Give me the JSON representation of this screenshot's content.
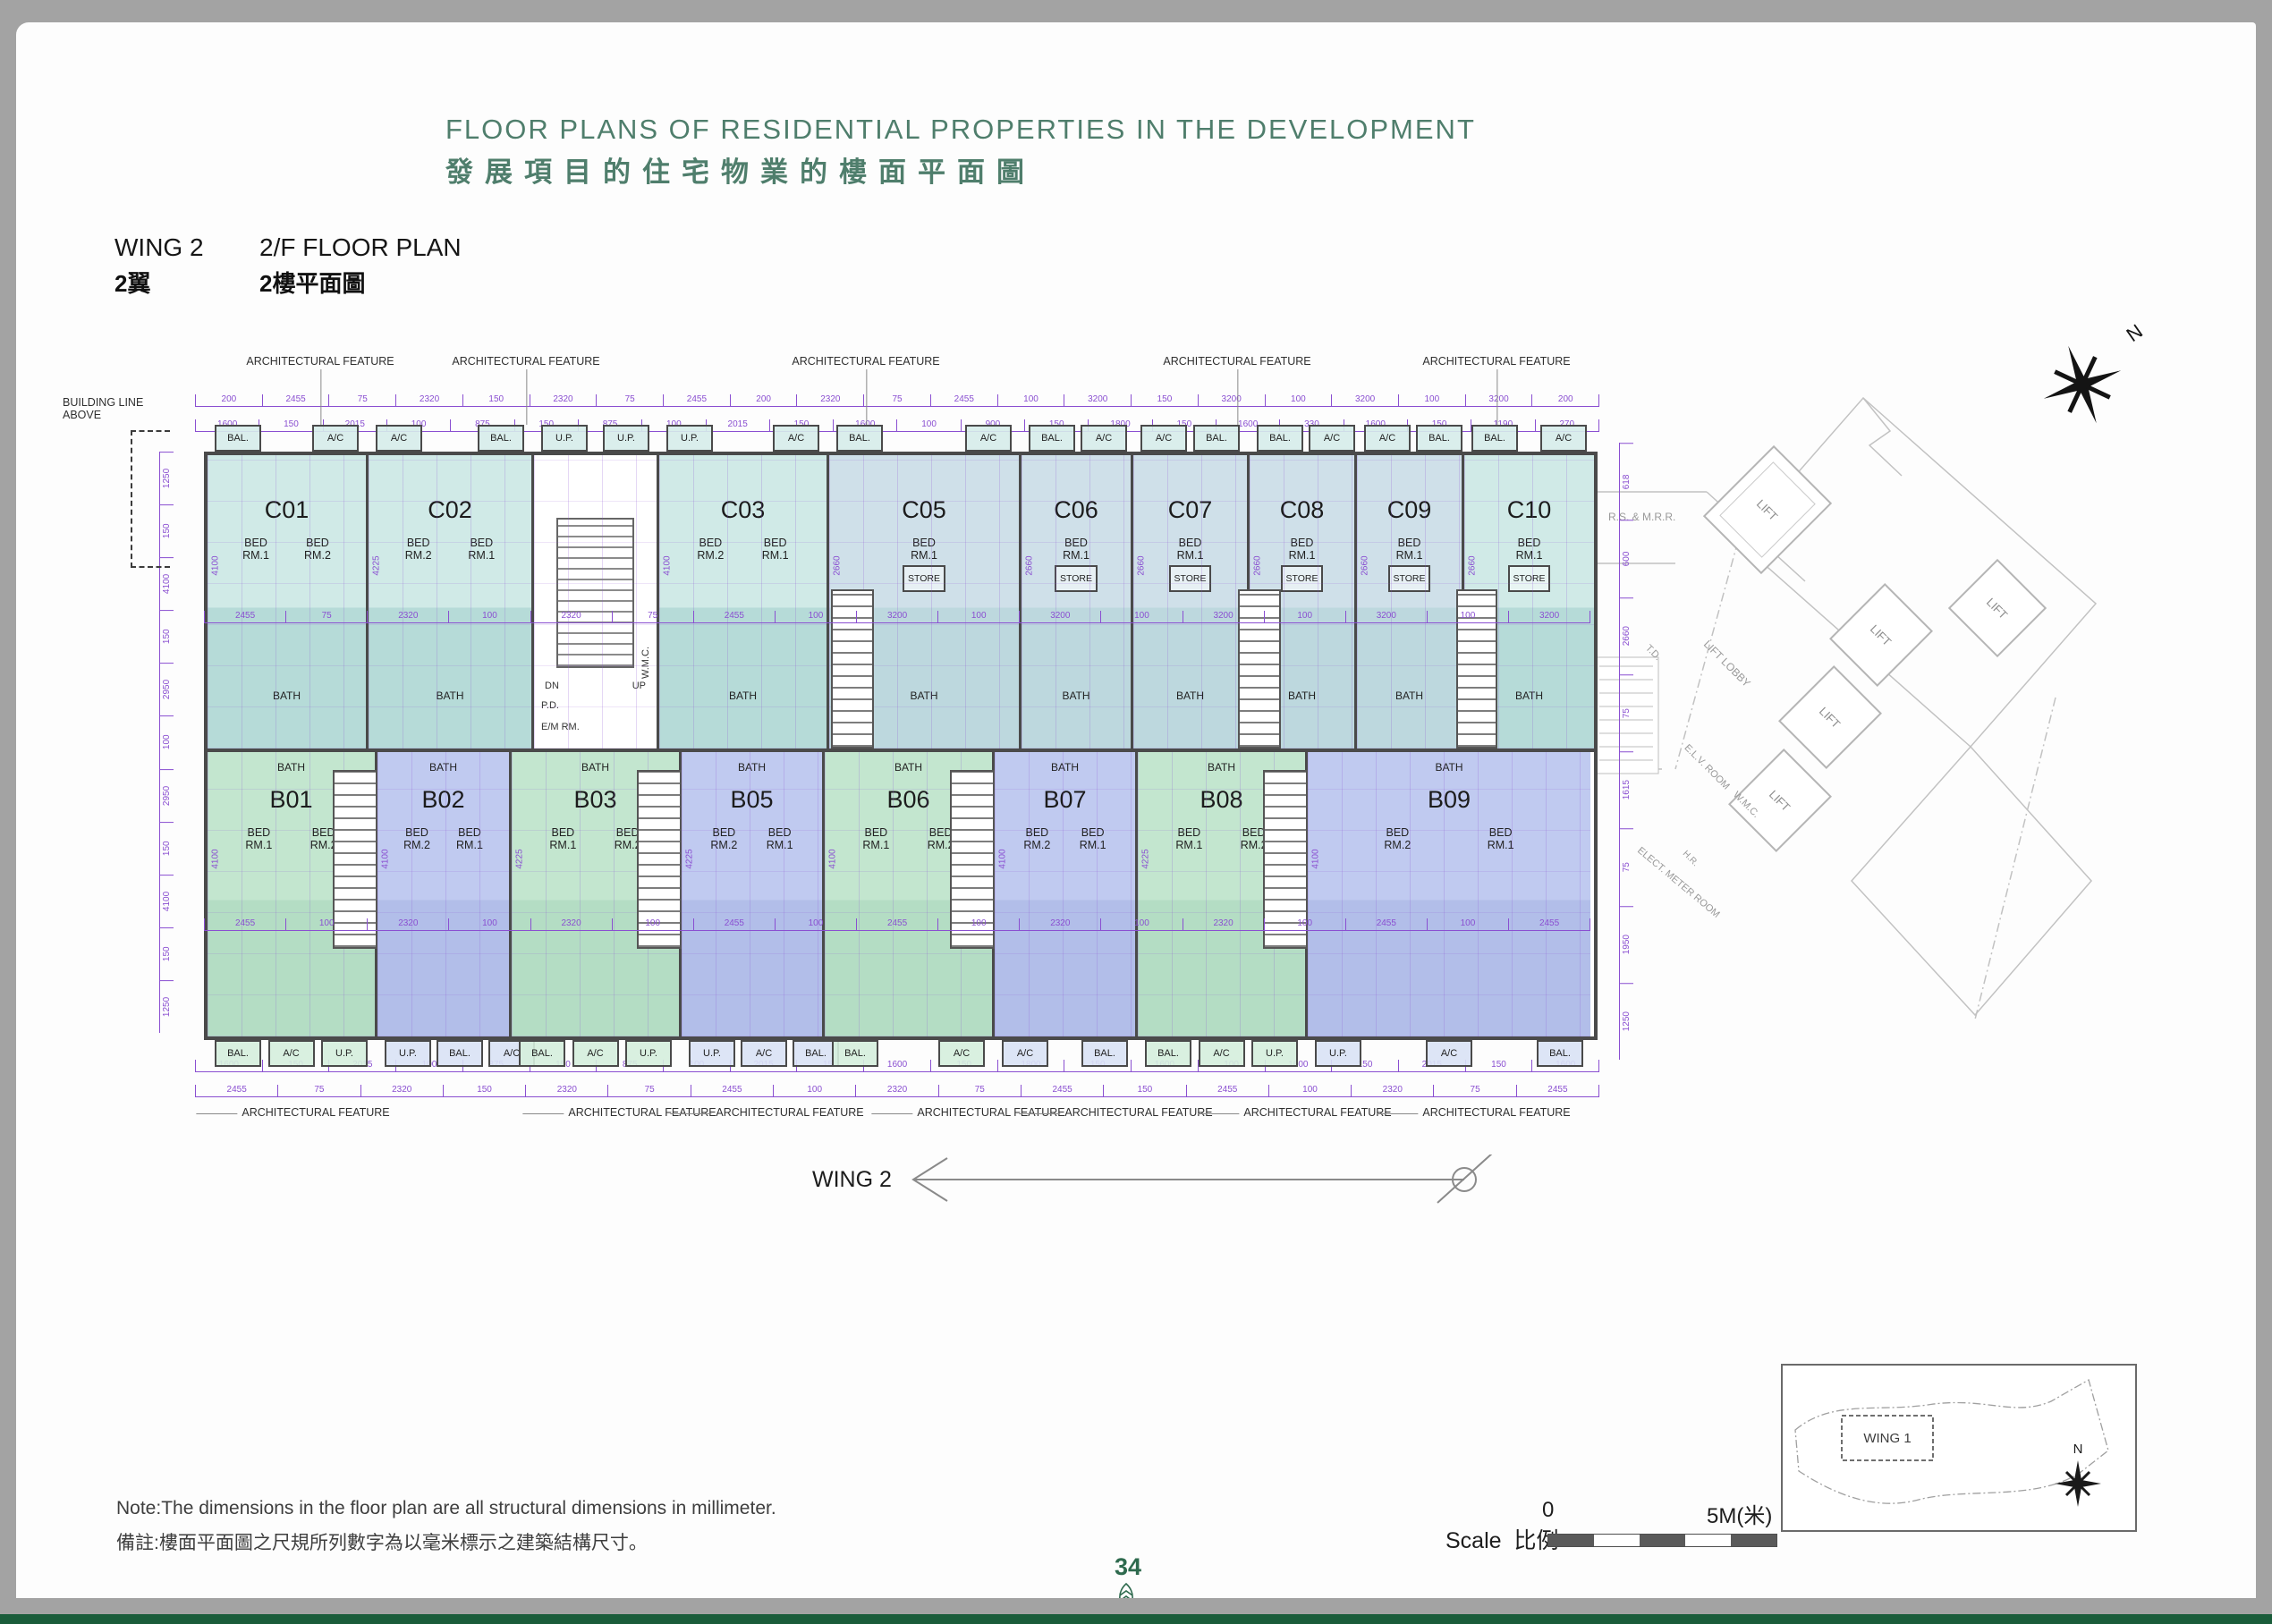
{
  "page": {
    "title_en": "FLOOR PLANS OF RESIDENTIAL PROPERTIES IN THE DEVELOPMENT",
    "title_zh": "發展項目的住宅物業的樓面平面圖",
    "wing_en": "WING 2",
    "wing_zh": "2翼",
    "floor_en": "2/F FLOOR PLAN",
    "floor_zh": "2樓平面圖",
    "note_en": "Note:The dimensions in the floor plan are all structural dimensions in millimeter.",
    "note_zh": "備註:樓面平面圖之尺規所列數字為以毫米標示之建築結構尺寸。",
    "page_number": "34"
  },
  "scalebar": {
    "label_en": "Scale",
    "label_zh": "比例",
    "zero": "0",
    "max": "5M(米)"
  },
  "keyplan": {
    "wing_label": "WING 1",
    "north": "N"
  },
  "compass": {
    "north": "N"
  },
  "arrow": {
    "label": "WING 2"
  },
  "common": {
    "lift": "LIFT",
    "lobby": "LIFT LOBBY",
    "td": "T.D.",
    "elv": "E.L.V. ROOM",
    "emr": "ELECT. METER ROOM",
    "wmc": "W.M.C.",
    "hr": "H.R.",
    "rsmrr": "R.S. & M.R.R.",
    "pd": "P.D."
  },
  "plan": {
    "architectural_feature": "ARCHITECTURAL FEATURE",
    "building_line": "BUILDING LINE ABOVE",
    "bath": "BATH",
    "core": {
      "dn": "DN",
      "up": "UP",
      "sub": [
        "P.D.",
        "E/M RM.",
        "W.M.C."
      ]
    },
    "units_top": [
      {
        "id": "C01",
        "fill": "teal",
        "vdim": "4100",
        "rooms": [
          "BED RM.1",
          "BED RM.2"
        ],
        "tabs": [
          "BAL.",
          "A/C"
        ]
      },
      {
        "id": "C02",
        "fill": "teal",
        "vdim": "4225",
        "rooms": [
          "BED RM.2",
          "BED RM.1"
        ],
        "tabs": [
          "A/C",
          "BAL."
        ]
      },
      {
        "id": "C03",
        "fill": "teal",
        "vdim": "4100",
        "rooms": [
          "BED RM.2",
          "BED RM.1"
        ],
        "tabs": [
          "U.P.",
          "A/C"
        ]
      },
      {
        "id": "C05",
        "fill": "pale",
        "vdim": "2660",
        "rooms": [
          "BED RM.1",
          "STORE"
        ],
        "tabs": [
          "BAL.",
          "A/C"
        ]
      },
      {
        "id": "C06",
        "fill": "pale",
        "vdim": "2660",
        "rooms": [
          "BED RM.1",
          "STORE"
        ],
        "tabs": [
          "BAL.",
          "A/C"
        ]
      },
      {
        "id": "C07",
        "fill": "pale",
        "vdim": "2660",
        "rooms": [
          "BED RM.1",
          "STORE"
        ],
        "tabs": [
          "A/C",
          "BAL."
        ]
      },
      {
        "id": "C08",
        "fill": "pale",
        "vdim": "2660",
        "rooms": [
          "BED RM.1",
          "STORE"
        ],
        "tabs": [
          "BAL.",
          "A/C"
        ]
      },
      {
        "id": "C09",
        "fill": "pale",
        "vdim": "2660",
        "rooms": [
          "BED RM.1",
          "STORE"
        ],
        "tabs": [
          "A/C",
          "BAL."
        ]
      },
      {
        "id": "C10",
        "fill": "teal",
        "vdim": "2660",
        "rooms": [
          "BED RM.1",
          "STORE"
        ],
        "tabs": [
          "BAL.",
          "A/C"
        ]
      }
    ],
    "units_bottom": [
      {
        "id": "B01",
        "fill": "green",
        "vdim": "4100",
        "rooms": [
          "BED RM.1",
          "BED RM.2"
        ],
        "tabs": [
          "BAL.",
          "A/C",
          "U.P."
        ]
      },
      {
        "id": "B02",
        "fill": "peri",
        "vdim": "4100",
        "rooms": [
          "BED RM.2",
          "BED RM.1"
        ],
        "tabs": [
          "U.P.",
          "BAL.",
          "A/C"
        ]
      },
      {
        "id": "B03",
        "fill": "green",
        "vdim": "4225",
        "rooms": [
          "BED RM.1",
          "BED RM.2"
        ],
        "tabs": [
          "BAL.",
          "A/C",
          "U.P."
        ]
      },
      {
        "id": "B05",
        "fill": "peri",
        "vdim": "4225",
        "rooms": [
          "BED RM.2",
          "BED RM.1"
        ],
        "tabs": [
          "U.P.",
          "A/C",
          "BAL."
        ]
      },
      {
        "id": "B06",
        "fill": "green",
        "vdim": "4100",
        "rooms": [
          "BED RM.1",
          "BED RM.2"
        ],
        "tabs": [
          "BAL.",
          "A/C"
        ]
      },
      {
        "id": "B07",
        "fill": "peri",
        "vdim": "4100",
        "rooms": [
          "BED RM.2",
          "BED RM.1"
        ],
        "tabs": [
          "A/C",
          "BAL."
        ]
      },
      {
        "id": "B08",
        "fill": "green",
        "vdim": "4225",
        "rooms": [
          "BED RM.1",
          "BED RM.2"
        ],
        "tabs": [
          "BAL.",
          "A/C",
          "U.P."
        ]
      },
      {
        "id": "B09",
        "fill": "peri",
        "vdim": "4100",
        "rooms": [
          "BED RM.2",
          "BED RM.1"
        ],
        "tabs": [
          "U.P.",
          "A/C",
          "BAL."
        ]
      }
    ],
    "dims": {
      "top_a": [
        "200",
        "2455",
        "75",
        "2320",
        "150",
        "2320",
        "75",
        "2455",
        "200",
        "2320",
        "75",
        "2455",
        "100",
        "3200",
        "150",
        "3200",
        "100",
        "3200",
        "100",
        "3200",
        "200"
      ],
      "top_b": [
        "1600",
        "150",
        "2015",
        "100",
        "875",
        "150",
        "875",
        "100",
        "2015",
        "150",
        "1600",
        "100",
        "900",
        "150",
        "1800",
        "150",
        "1600",
        "330",
        "1600",
        "150",
        "1190",
        "270"
      ],
      "interior_top": [
        "2455",
        "75",
        "2320",
        "100",
        "2320",
        "75",
        "2455",
        "100",
        "3200",
        "100",
        "3200",
        "100",
        "3200",
        "100",
        "3200",
        "100",
        "3200"
      ],
      "interior_bottom": [
        "2455",
        "100",
        "2320",
        "100",
        "2320",
        "100",
        "2455",
        "100",
        "2455",
        "100",
        "2320",
        "100",
        "2320",
        "100",
        "2455",
        "100",
        "2455"
      ],
      "bottom_a": [
        "1600",
        "150",
        "2015",
        "100",
        "875",
        "150",
        "875",
        "100",
        "2015",
        "150",
        "1600",
        "150",
        "1800",
        "150",
        "1600",
        "100",
        "1600",
        "150",
        "2015",
        "150",
        "1600"
      ],
      "bottom_b": [
        "2455",
        "75",
        "2320",
        "150",
        "2320",
        "75",
        "2455",
        "100",
        "2320",
        "75",
        "2455",
        "150",
        "2455",
        "100",
        "2320",
        "75",
        "2455"
      ],
      "left": [
        "1250",
        "150",
        "4100",
        "150",
        "2950",
        "100",
        "2950",
        "150",
        "4100",
        "150",
        "1250"
      ],
      "right": [
        "618",
        "600",
        "2660",
        "75",
        "1615",
        "75",
        "1950",
        "1250"
      ]
    }
  },
  "colors": {
    "title_green": "#4f7e6c",
    "page_number_green": "#2e6a4e",
    "dimension_purple": "#8a4fd1",
    "wall_grey": "#4a4a4a",
    "unit_teal": "#b6dbd8",
    "unit_pale_blue": "#bdd8de",
    "unit_green": "#b4ddc4",
    "unit_periwinkle": "#b2bee9",
    "common_line_grey": "#bdbdbd",
    "footer_band_grey": "#a3a3a3",
    "footer_band_green": "#1a5c3a"
  }
}
